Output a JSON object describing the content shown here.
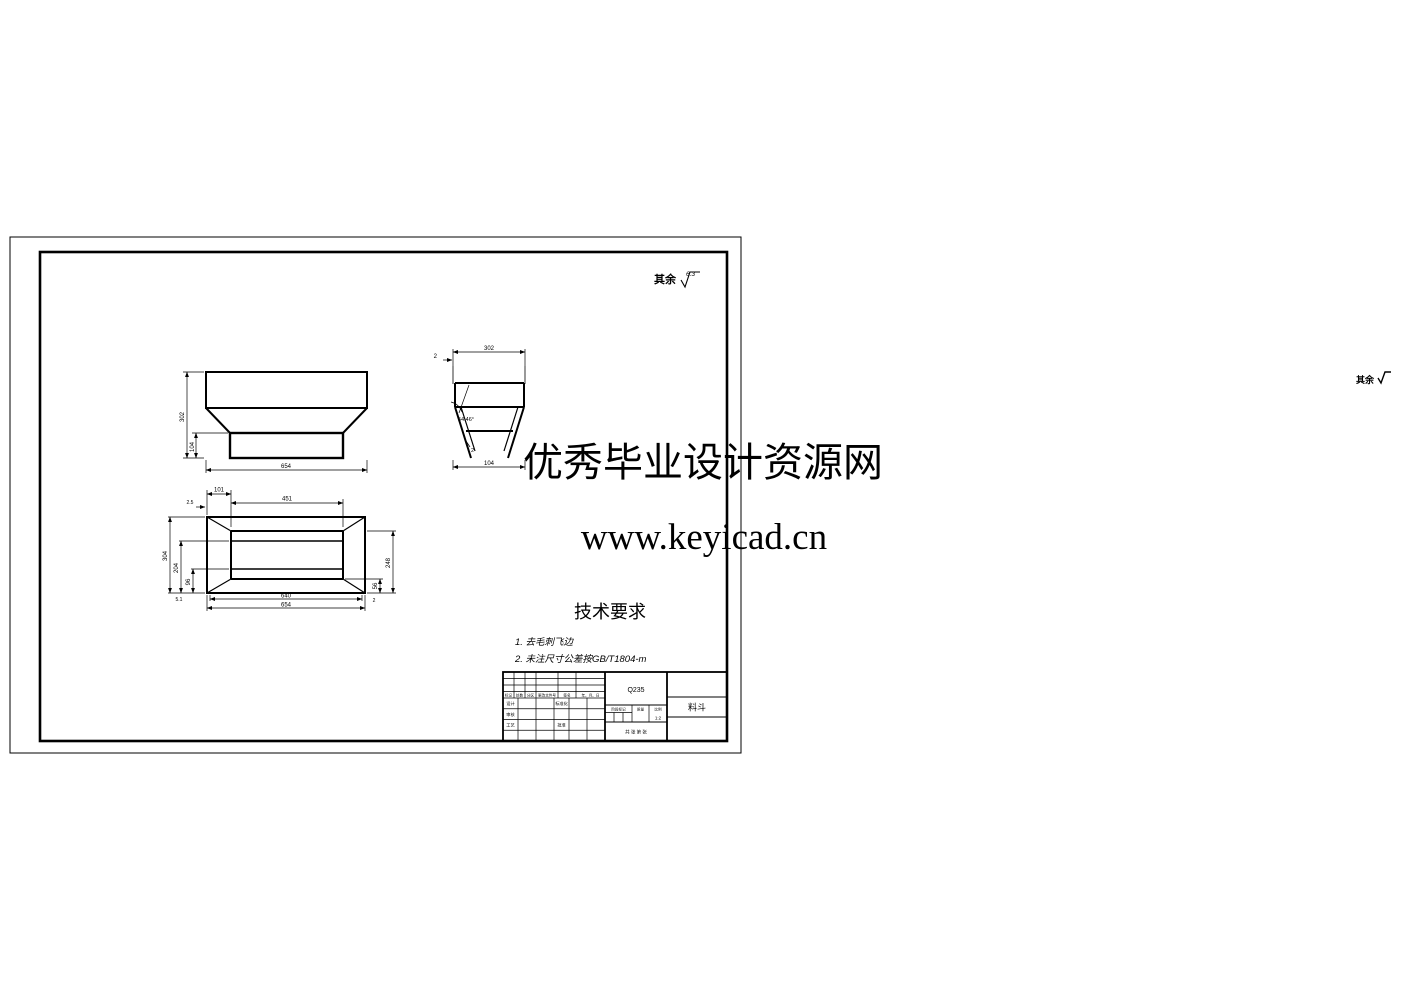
{
  "watermark": {
    "line1": "优秀毕业设计资源网",
    "line2": "www.keyicad.cn",
    "color": "#e60012"
  },
  "notes": {
    "surface_prefix": "其余",
    "surface_value": "6.3",
    "corner_note": "其余"
  },
  "tech_req": {
    "title": "技术要求",
    "item1": "1. 去毛刺飞边",
    "item2": "2. 未注尺寸公差按GB/T1804-m"
  },
  "dims": {
    "front": {
      "width": "654",
      "height": "302",
      "lower": "104"
    },
    "side": {
      "top": "302",
      "bottom": "104",
      "thk": "2",
      "angle": "54.46°",
      "wall": "2"
    },
    "plan": {
      "flange": "101",
      "inner_top": "451",
      "off": "2.5",
      "l1": "304",
      "l2": "204",
      "l3": "96",
      "r1": "248",
      "r2": "56",
      "r3": "2",
      "b0": "5.1",
      "b1": "640",
      "b2": "654"
    }
  },
  "title_block": {
    "material": "Q235",
    "part": "料斗",
    "scale": "1:2",
    "stage": "阶段标记",
    "mass": "质量",
    "scale_label": "比例",
    "sheets": "共  张  第  张",
    "rev": {
      "c1": "标记",
      "c2": "处数",
      "c3": "分区",
      "c4": "更改文件号",
      "c5": "签名",
      "c6": "年、月、日"
    },
    "roles": {
      "design": "设计",
      "std": "标准化",
      "check": "审核",
      "proc": "工艺",
      "appr": "批准"
    }
  }
}
